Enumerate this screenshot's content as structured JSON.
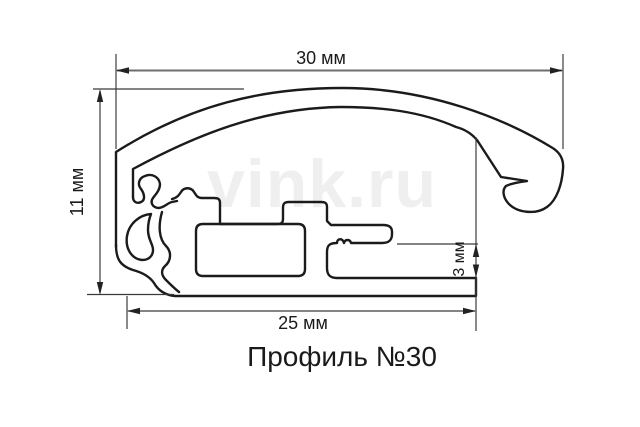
{
  "drawing": {
    "title": "Профиль №30",
    "watermark": "vink.ru",
    "dimensions": {
      "top_width": {
        "label": "30 мм",
        "value_mm": 30
      },
      "left_height": {
        "label": "11 мм",
        "value_mm": 11
      },
      "bottom_width": {
        "label": "25 мм",
        "value_mm": 25
      },
      "slot_height": {
        "label": "3 мм",
        "value_mm": 3
      }
    },
    "colors": {
      "line": "#1b1b1b",
      "dimension_line": "#3b3b3b",
      "watermark": "#efefef",
      "background": "#ffffff"
    }
  }
}
